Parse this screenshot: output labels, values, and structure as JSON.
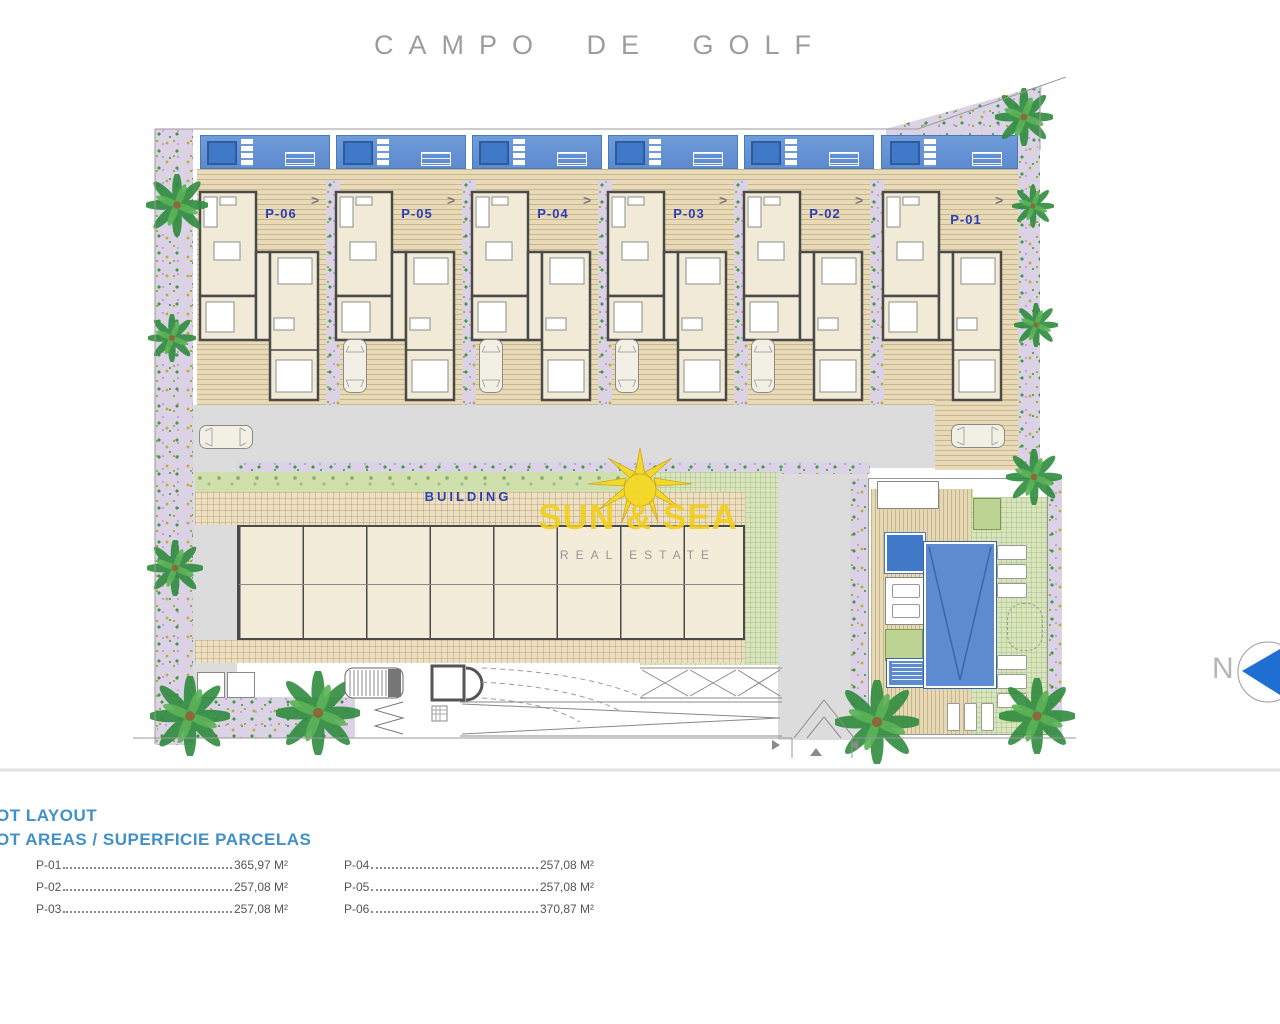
{
  "title": "CAMPO DE GOLF",
  "plots": [
    {
      "id": "P-06"
    },
    {
      "id": "P-05"
    },
    {
      "id": "P-04"
    },
    {
      "id": "P-03"
    },
    {
      "id": "P-02"
    },
    {
      "id": "P-01"
    }
  ],
  "building_label": "BUILDING",
  "logo": {
    "name": "SUN & SEA",
    "subtitle": "REAL ESTATE"
  },
  "compass": {
    "north": "N"
  },
  "legend": {
    "line1": "OT LAYOUT",
    "line2": "OT AREAS / SUPERFICIE PARCELAS",
    "rows": [
      {
        "id": "P-01",
        "area": "365,97 M²"
      },
      {
        "id": "P-02",
        "area": "257,08 M²"
      },
      {
        "id": "P-03",
        "area": "257,08 M²"
      },
      {
        "id": "P-04",
        "area": "257,08 M²"
      },
      {
        "id": "P-05",
        "area": "257,08 M²"
      },
      {
        "id": "P-06",
        "area": "370,87 M²"
      }
    ]
  },
  "colors": {
    "pool_blue": "#5d8bd0",
    "pool_dark": "#3f79c8",
    "deck_tan": "#e8dab6",
    "plot_label_blue": "#2b3fb5",
    "legend_blue": "#4191c9",
    "lawn_green": "#d9e6bc",
    "hedge_green": "#cfe0ad",
    "garden_lavender": "#dcd2e6",
    "road_gray": "#dcdcdc",
    "logo_yellow": "#f2cf1e",
    "compass_blue": "#1e6fd1"
  }
}
